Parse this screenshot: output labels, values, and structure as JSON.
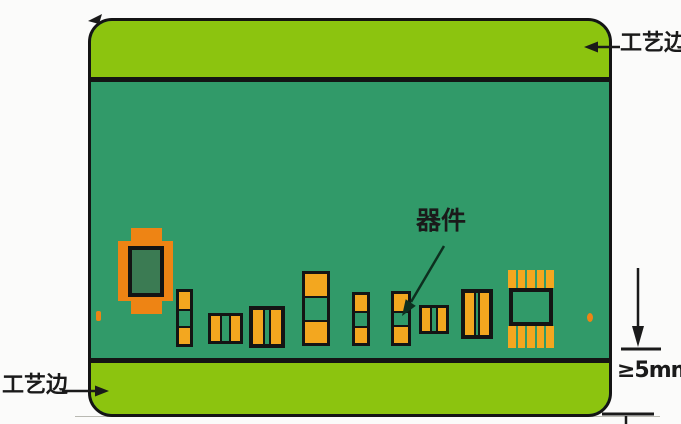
{
  "labels": {
    "process_edge_top": "工艺边",
    "process_edge_bottom": "工艺边",
    "component": "器件",
    "min_edge_width": "≥5mm"
  },
  "colors": {
    "background": "#fbfbfa",
    "edge_strip_green": "#8cc40f",
    "board_green": "#319a69",
    "outline": "#141414",
    "pad_orange": "#f3a71f",
    "large_pad_orange": "#ee8414",
    "inner_body_green": "#3b7b53",
    "annotation": "#1a1a1a"
  }
}
